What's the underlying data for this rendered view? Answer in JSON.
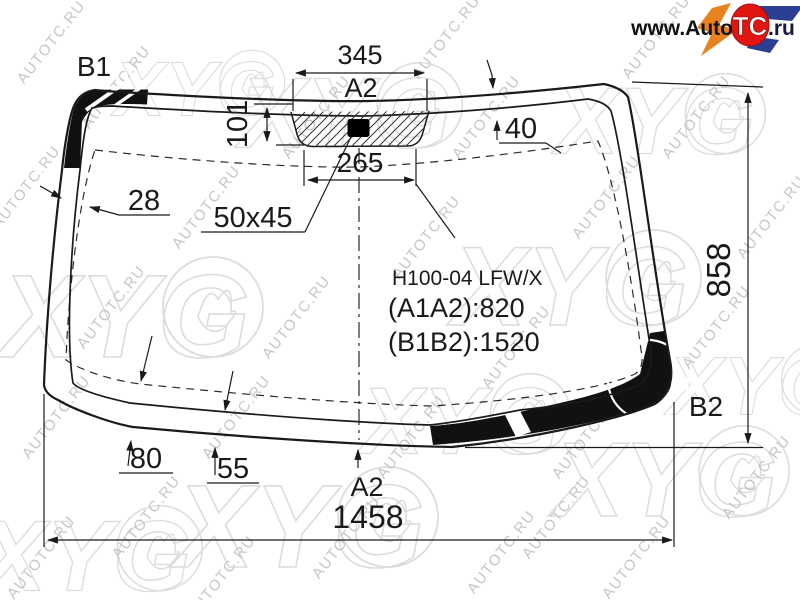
{
  "header_logo": {
    "www": "www.Auto",
    "tc": "TC",
    "ru": ".ru"
  },
  "corner_labels": {
    "b1": "B1",
    "b2": "B2"
  },
  "center_labels": {
    "a2_top": "A2",
    "a2_bottom": "A2"
  },
  "dimensions": {
    "top_opening_width": "345",
    "mirror_base_width": "265",
    "upper_band_depth": "101",
    "top_band_width": "40",
    "left_band_width": "28",
    "mirror_pad_size": "50x45",
    "lower_band_a": "80",
    "lower_band_b": "55",
    "glass_height": "858",
    "glass_width": "1458"
  },
  "part_info": {
    "part_number": "H100-04 LFW/X",
    "a_distance": "(A1A2):820",
    "b_distance": "(B1B2):1520"
  },
  "watermark": {
    "tile_text": "AUTOTC.RU",
    "brand": "XYG"
  },
  "colors": {
    "line": "#1a1a1a",
    "watermark_text": "#c6c6c6",
    "watermark_logo": "#dcdcdc",
    "logo_red": "#e01710",
    "logo_orange": "#e8821f",
    "logo_blue": "#2b3e92"
  }
}
